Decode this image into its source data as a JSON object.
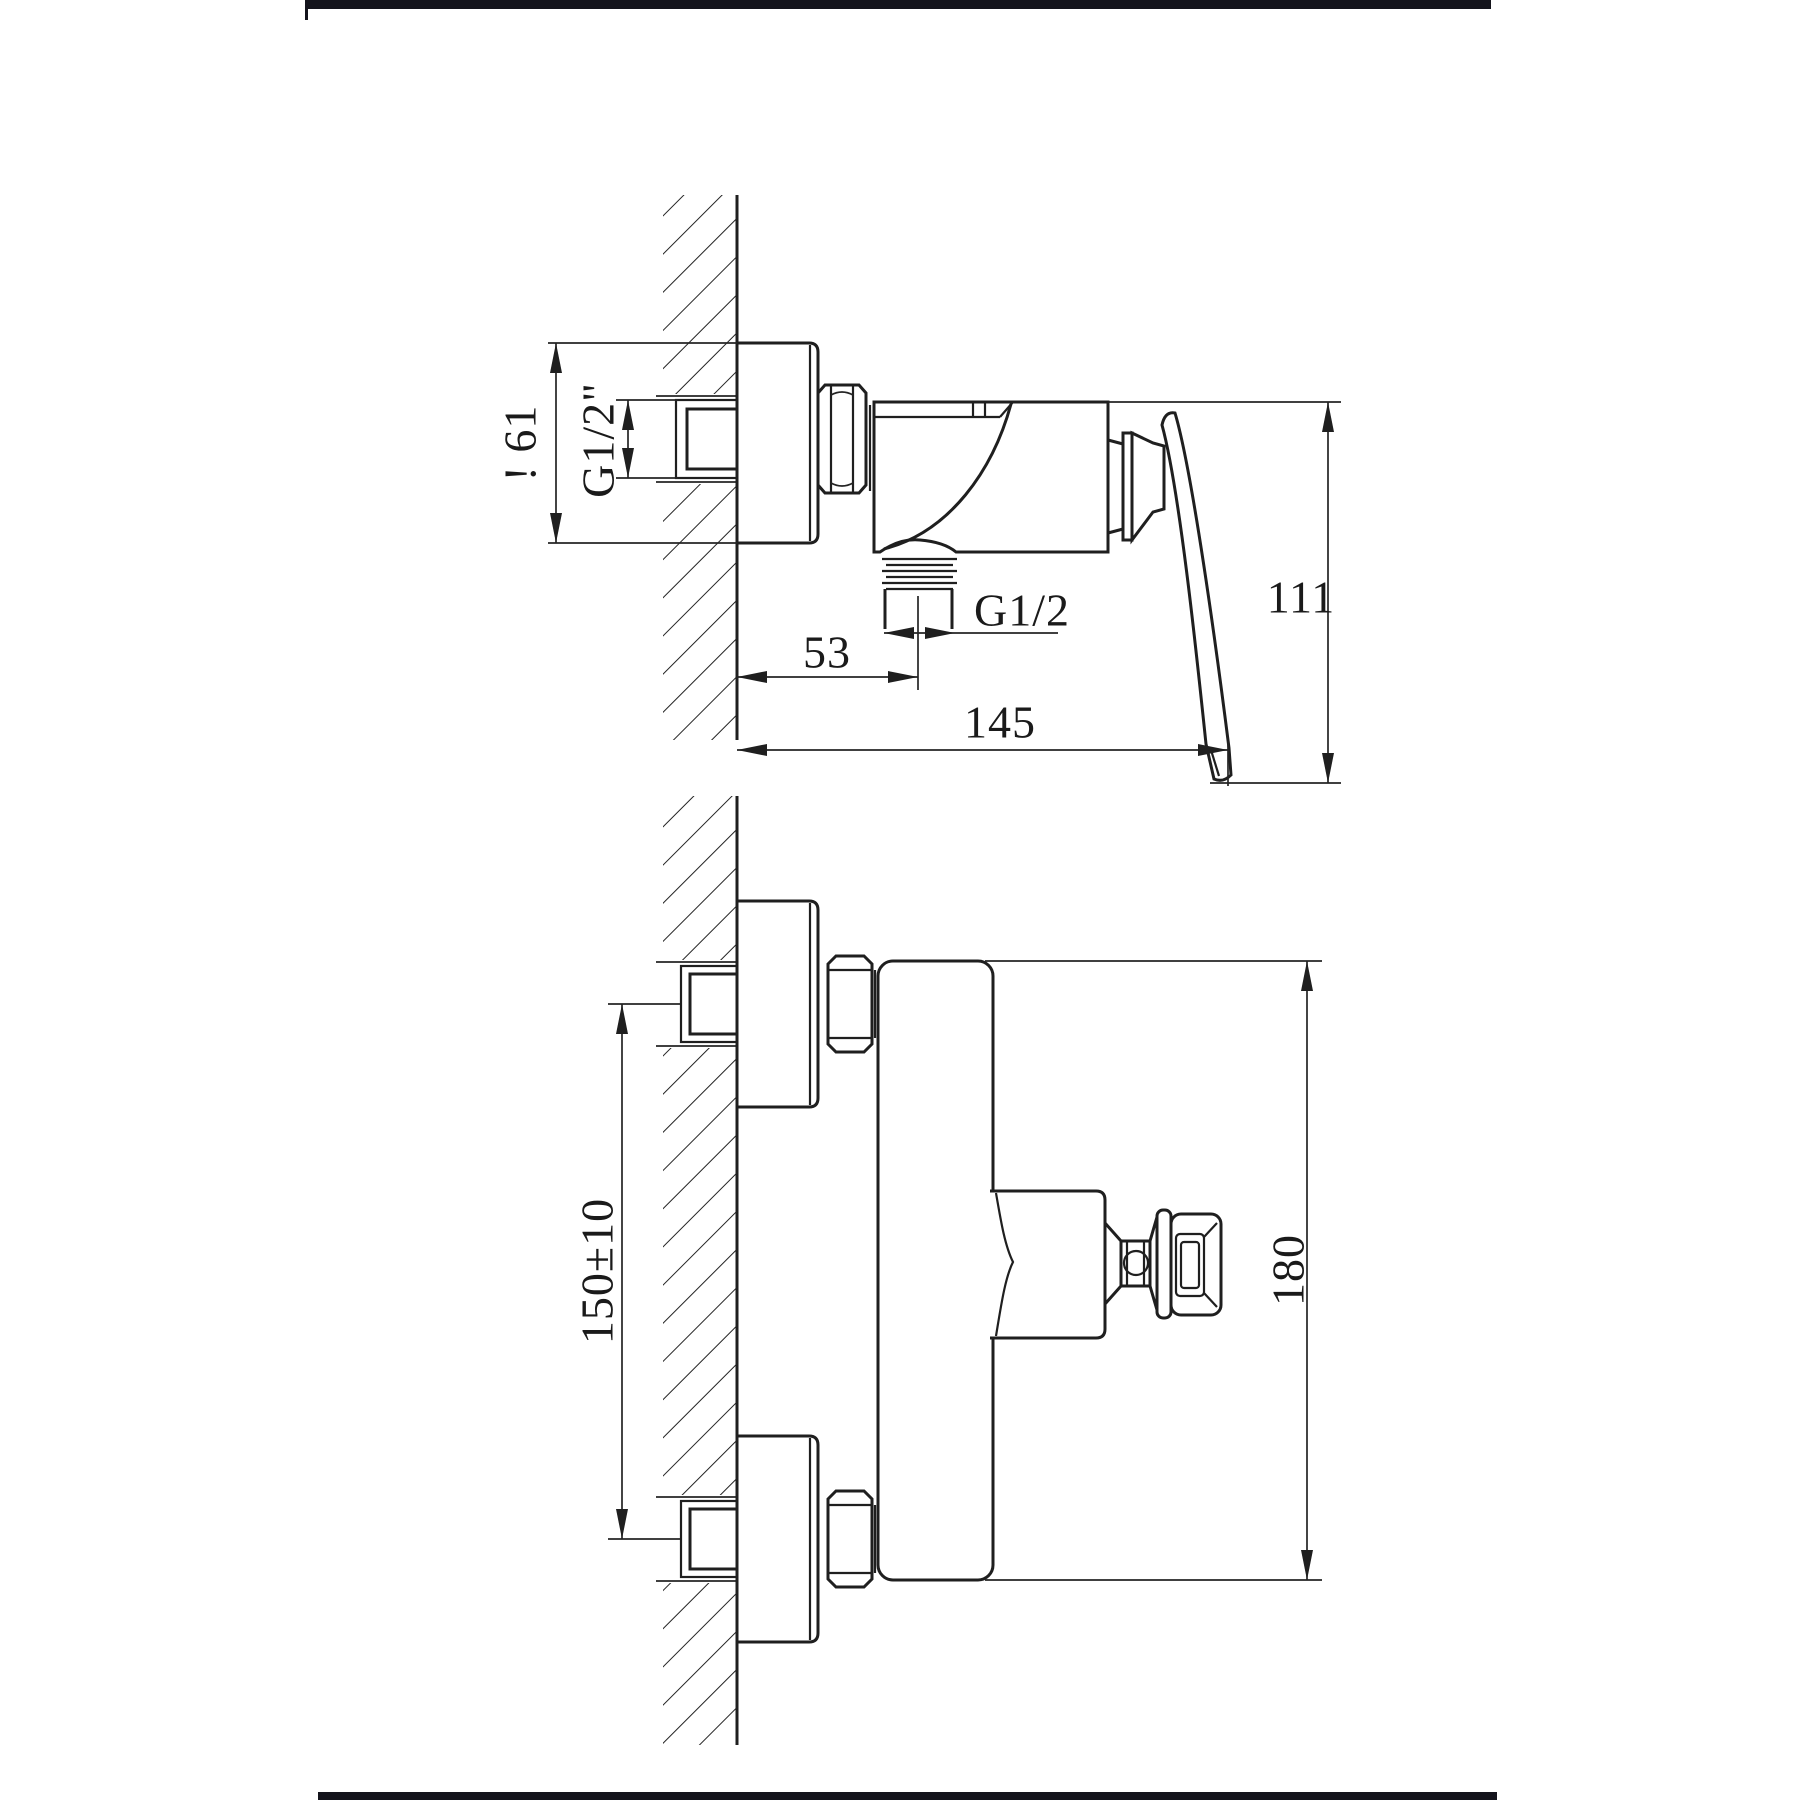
{
  "page": {
    "background": "#ffffff",
    "border_bar_color": "#14141c",
    "line_color": "#1f1f1f"
  },
  "dims": {
    "side_bracket_height": "! 61",
    "side_inlet_thread": "G1/2\"",
    "side_outlet_offset": "53",
    "side_outlet_thread": "G1/2",
    "side_total_depth": "145",
    "side_height": "111",
    "front_inlet_spacing": "150±10",
    "front_total_height": "180"
  }
}
